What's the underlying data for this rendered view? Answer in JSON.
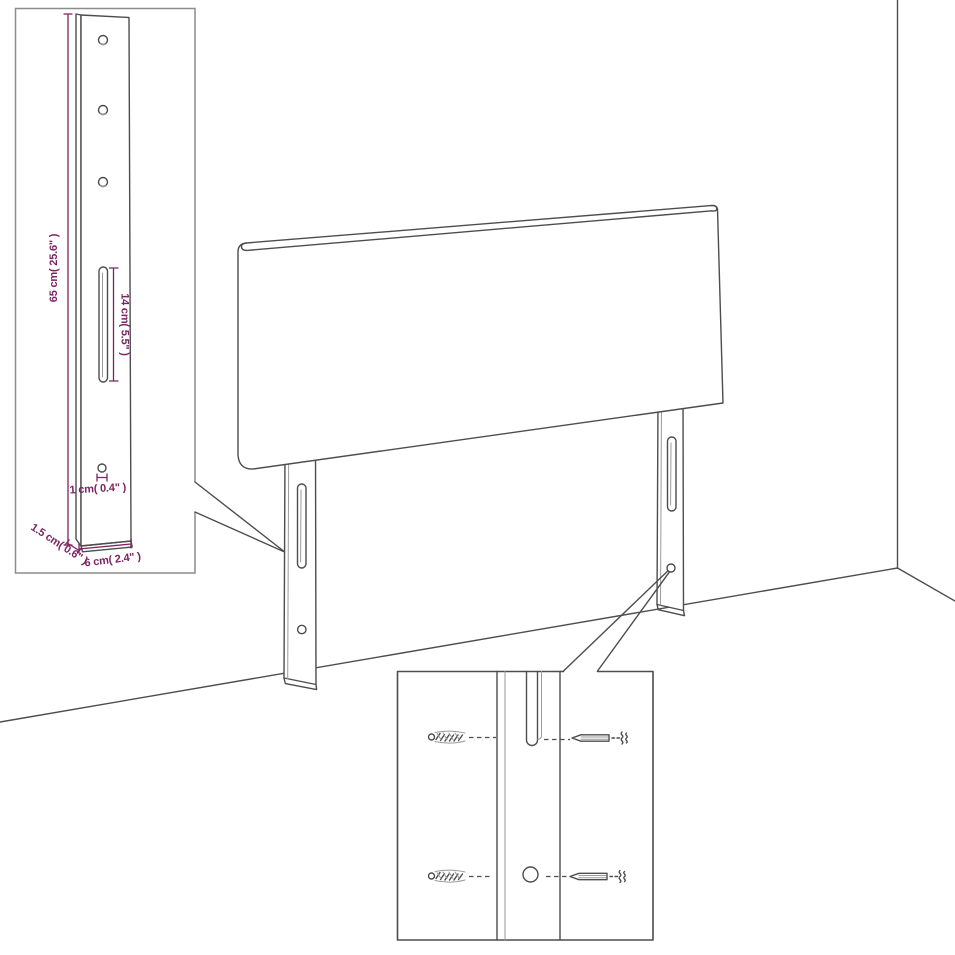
{
  "title": "Headboard wall-mount dimension diagram",
  "colors": {
    "background": "#ffffff",
    "line": "#4d4d4d",
    "dimension_text": "#7b2562",
    "inset_border": "#8c8c8c"
  },
  "leg_detail_inset": {
    "dim_height": "65 cm( 25.6\" )",
    "dim_slot": "14 cm( 5.5\" )",
    "dim_hole": "1 cm( 0.4\" )",
    "dim_thickness": "1.5 cm( 0.6\" )",
    "dim_width": "6 cm( 2.4\" )"
  },
  "hardware_inset": {
    "items": [
      "wall-plug",
      "screw"
    ]
  }
}
